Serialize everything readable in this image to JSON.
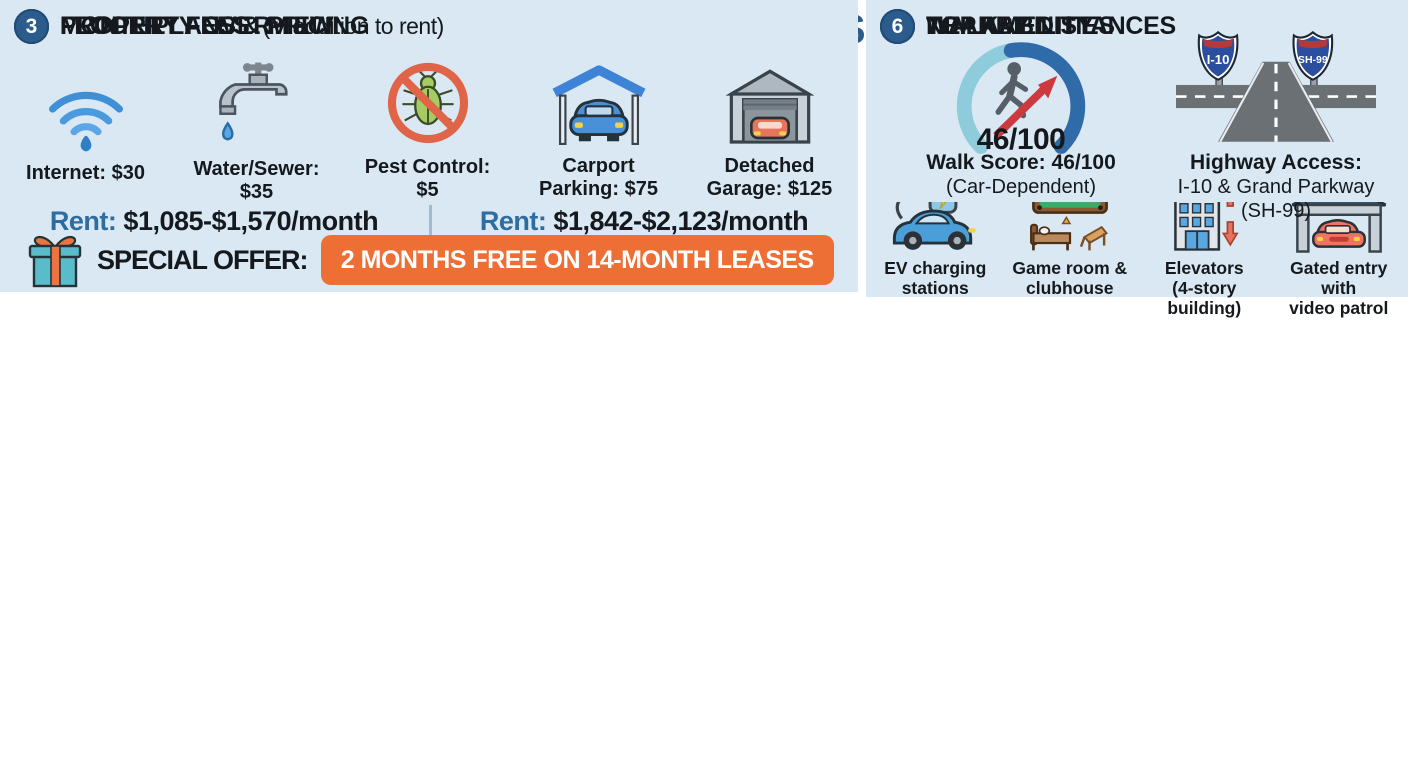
{
  "header": {
    "title_main": "LOFTS AT KATY RANCH APARTMENTS",
    "title_sep": " - ",
    "title_sub": "QUICK REFERENCE"
  },
  "colors": {
    "title_blue": "#2d5b87",
    "title_gray": "#8b9096",
    "panel_bg": "#d9e8f2",
    "badge_blue": "#2b5c8c",
    "plan_bar_blue": "#3a6591",
    "label_blue": "#2e6da0",
    "offer_orange": "#ee6f35",
    "gauge_light": "#8ecbdb",
    "gauge_dark": "#2e6ba8"
  },
  "s1": {
    "num": "1",
    "title": "PROPERTY OVERVIEW",
    "big": "55+",
    "big_sub": "ACTIVE\nADULTS",
    "community_label": "55+ ACTIVE ADULTS\nCOMMUNITY TYPE",
    "calendar_year": "2025",
    "built_label": "BUILT: 2025\n(NEW CONSTRUCTION)",
    "units_label": "TOTAL UNITS:\n218",
    "address_title": "ADDRESS:",
    "address": "24922 Katy Ranch Rd,\nKaty, TX 77494"
  },
  "s2": {
    "num": "2",
    "title": "FLOOR PLANS & PRICING",
    "plans": [
      {
        "name": "ONE-BEDROOM",
        "size_plain": "Size: 589-803 sq ft",
        "size_label": "Size:",
        "size_value": " 589-803 sq ft",
        "rent_label": "Rent:",
        "rent_value": " $1,085-$1,570/month"
      },
      {
        "name": "TWO-BEDROOM",
        "size_plain": "Size: 983-1,128 sq ft",
        "size_label": "Size:",
        "size_value": " 983-1,128 sq ft",
        "rent_label": "Rent:",
        "rent_value": " $1,842-$2,123/month"
      }
    ],
    "offer_label": "SPECIAL OFFER:",
    "offer_badge": "2 MONTHS FREE ON 14-MONTH LEASES"
  },
  "s3": {
    "num": "3",
    "title": "MONTHLY FEES",
    "note": "(in addition to rent)",
    "fees": [
      {
        "icon": "wifi-icon",
        "label": "Internet: $30"
      },
      {
        "icon": "faucet-icon",
        "label": "Water/Sewer:\n$35"
      },
      {
        "icon": "pest-control-icon",
        "label": "Pest Control:\n$5"
      },
      {
        "icon": "carport-icon",
        "label": "Carport\nParking: $75"
      },
      {
        "icon": "garage-icon",
        "label": "Detached\nGarage: $125"
      }
    ]
  },
  "s4": {
    "num": "4",
    "title": "TOP AMENITIES",
    "amenities": [
      {
        "icon": "pool-icon",
        "strong": "Resort-style pool\nwith cabana",
        "normal": ""
      },
      {
        "icon": "fitness-icon",
        "strong": "24-hour fitness\ncenter",
        "normal": ""
      },
      {
        "icon": "dog-park-icon",
        "strong": "Dog park",
        "normal": " (pets up\nto 35 lbs, $35/month)"
      },
      {
        "icon": "ev-charging-icon",
        "strong": "EV charging\nstations",
        "normal": ""
      },
      {
        "icon": "game-room-icon",
        "strong": "Game room &\nclubhouse",
        "normal": ""
      },
      {
        "icon": "elevators-icon",
        "strong": "Elevators\n(4-story building)",
        "normal": ""
      },
      {
        "icon": "gated-entry-icon",
        "strong": "Gated entry with\nvideo patrol",
        "normal": ""
      }
    ]
  },
  "s5": {
    "num": "5",
    "title": "NEARBY DISTANCES",
    "places": [
      {
        "icon": "hospital-icon",
        "name": "Memorial Hermann\nKaty Hospital:",
        "value": " 1.6 miles"
      },
      {
        "icon": "map-pin-icon",
        "name": "Katy Ranch\nCrossing:",
        "value": " 0.2 miles"
      },
      {
        "icon": "mall-icon",
        "name": "Katy Mills Mall:",
        "value": "\n0.9 miles"
      },
      {
        "icon": "park-trees-icon",
        "name": "George Bush\nPark:",
        "value": " 7.3 miles"
      },
      {
        "icon": "city-corridor-icon",
        "name": "Houston Energy Corridor:",
        "value": "\nEasy access via I-10"
      }
    ]
  },
  "s6": {
    "num": "6",
    "title": "WALKABILITY",
    "gauge_score": "46/100",
    "walk_strong": "Walk Score: 46/100",
    "walk_normal": "(Car-Dependent)",
    "signs": [
      {
        "label": "I-10"
      },
      {
        "label": "SH-99"
      }
    ],
    "hw_strong": "Highway Access:",
    "hw_normal": "I-10 & Grand Parkway (SH-99)"
  }
}
